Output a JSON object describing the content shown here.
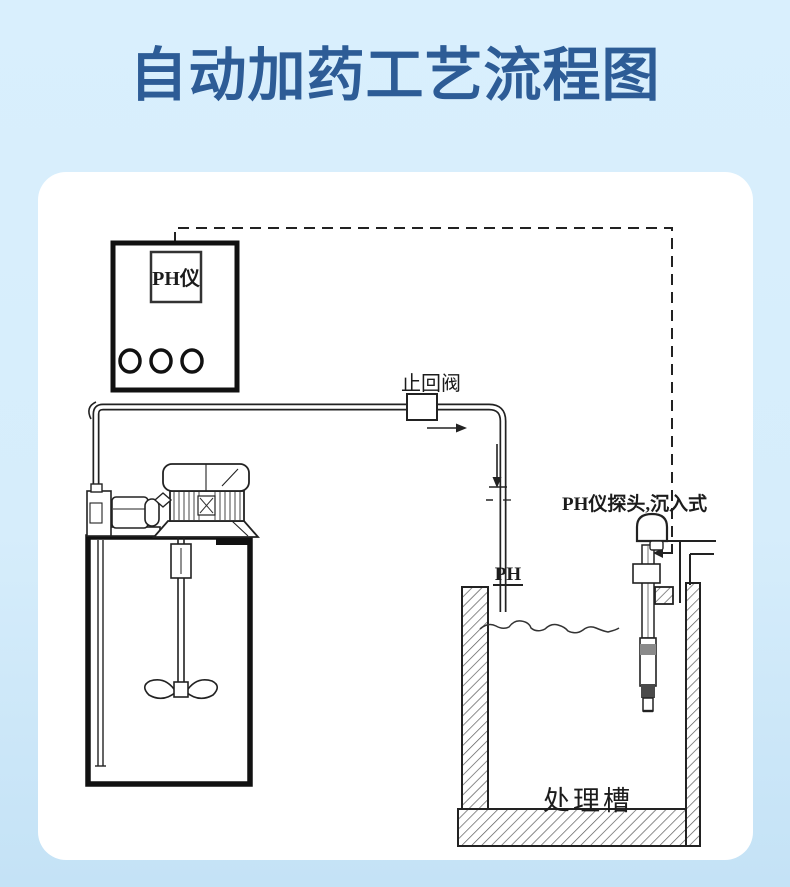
{
  "page": {
    "title": "自动加药工艺流程图",
    "background_color": "#d7eefc",
    "title_color": "#2d5c96",
    "card_color": "#ffffff"
  },
  "diagram": {
    "type": "process-flow-diagram",
    "line_color": "#222222",
    "dashed_signal_line": "PH controller to probe",
    "labels": {
      "controller": "PH仪",
      "check_valve": "止回阀",
      "probe": "PH仪探头,沉入式",
      "pipe_outlet": "PH",
      "treatment_tank": "处理槽"
    }
  }
}
